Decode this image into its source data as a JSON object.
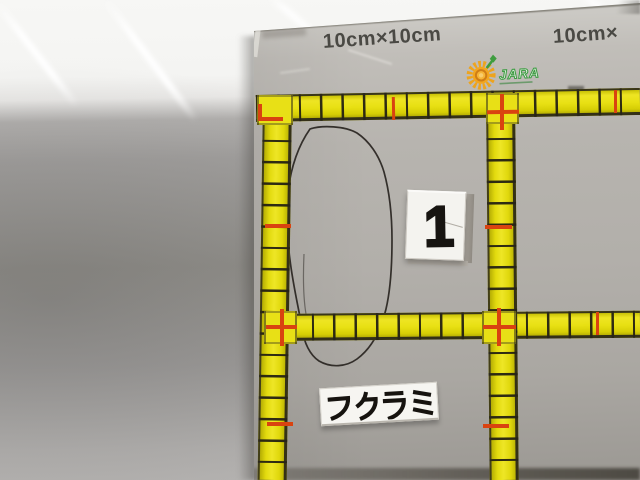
{
  "photo": {
    "description": "JARA 10cm calibration ruler board on a grey vehicle panel with hand-drawn damage outline, marker number card and damage label"
  },
  "board": {
    "scale_label_left": "10cm×10cm",
    "scale_label_right": "10cm×",
    "logo_text": "JARA",
    "marker_number": "1",
    "damage_label": "フクラミ"
  },
  "ruler": {
    "cell_size_cm": 10,
    "tick_interval_cm": 1,
    "red_mark_interval_cm": 5
  },
  "icons": {
    "logo_icon": "jara-sunflower-icon",
    "damage_outline": "hand-drawn-ellipse"
  },
  "colors": {
    "ruler_yellow": "#e8e013",
    "mark_red": "#d94310",
    "logo_green": "#3f9d44",
    "logo_orange": "#f2a61f",
    "board_gray": "#b2afaa",
    "pen_black": "#282420"
  }
}
